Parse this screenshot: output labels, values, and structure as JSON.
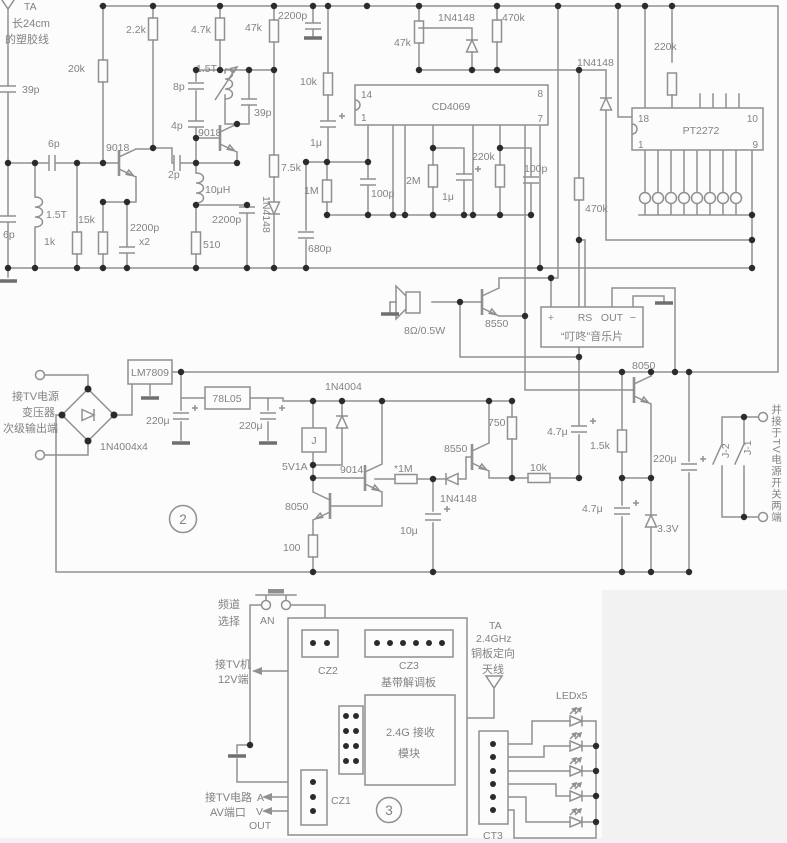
{
  "b1": {
    "ta": "TA",
    "ant1": "长24cm",
    "ant2": "的塑胶线",
    "c39pa": "39p",
    "c6pa": "6p",
    "l15ta": "1.5T",
    "c6pb": "6p",
    "r1k": "1k",
    "r15k": "15k",
    "r20k": "20k",
    "q1": "9018",
    "r2k2": "2.2k",
    "c2200pa": "2200p",
    "c2200pa2": "x2",
    "r4k7": "4.7k",
    "l15tb": "1.5T",
    "c8p": "8p",
    "c4p": "4p",
    "q2": "9018",
    "c2p": "2p",
    "l10uh": "10μH",
    "c2200pb": "2200p",
    "r510": "510",
    "c39pb": "39p",
    "r7k5": "7.5k",
    "d1": "1N4148",
    "r47ka": "47k",
    "c2200pc": "2200p",
    "r10ka": "10k",
    "c1ua": "1μ",
    "r1m": "1M",
    "c680p": "680p",
    "c100pa": "100p",
    "r47kb": "47k",
    "d2": "1N4148",
    "r470ka": "470k",
    "ic1": "CD4069",
    "ic1p14": "14",
    "ic1p1": "1",
    "ic1p8": "8",
    "ic1p7": "7",
    "r2m": "2M",
    "c1ub": "1μ",
    "r220ka": "220k",
    "c100pb": "100p",
    "d3": "1N4148",
    "r470kb": "470k",
    "r220kb": "220k",
    "ic2": "PT2272",
    "ic2p18": "18",
    "ic2p1": "1",
    "ic2p10": "10",
    "ic2p9": "9"
  },
  "b2": {
    "spk": "8Ω/0.5W",
    "q3": "8550",
    "mcp": "+",
    "mcrs": "RS",
    "mcout": "OUT",
    "mcm": "−",
    "mcname": "“叮咚”音乐片",
    "q4": "8050",
    "tin1": "接TV电源",
    "tin2": "变压器",
    "tin3": "次级输出端",
    "bridge": "1N4004x4",
    "reg1": "LM7809",
    "c220ua": "220μ",
    "reg2": "78L05",
    "c220ub": "220μ",
    "circ2": "2",
    "d4": "1N4004",
    "relay": "J",
    "rspec": "5V1A",
    "q5": "9014",
    "r1mb": "*1M",
    "q6": "8550",
    "r750": "750",
    "d5": "1N4148",
    "c10u": "10μ",
    "q7": "8050",
    "r100": "100",
    "c4u7a": "4.7μ",
    "r1k5": "1.5k",
    "c220uc": "220μ",
    "r10kb": "10k",
    "c4u7b": "4.7μ",
    "dz": "3.3V",
    "j1": "J-1",
    "j2": "J-2",
    "note": "并接于TV电源开关两端"
  },
  "b3": {
    "ch1": "频道",
    "ch2": "选择",
    "an": "AN",
    "cz2": "CZ2",
    "cz3": "CZ3",
    "bb": "基带解调板",
    "tv1": "接TV机",
    "tv2": "12V端",
    "ta1": "TA",
    "ta2": "2.4GHz",
    "ta3": "铜板定向",
    "ta4": "天线",
    "mod1": "2.4G 接收",
    "mod2": "模块",
    "cz1": "CZ1",
    "av1": "接TV电路",
    "av2": "AV端口",
    "a": "A",
    "v": "V",
    "out": "OUT",
    "circ3": "3",
    "led": "LEDx5",
    "ct3": "CT3"
  }
}
